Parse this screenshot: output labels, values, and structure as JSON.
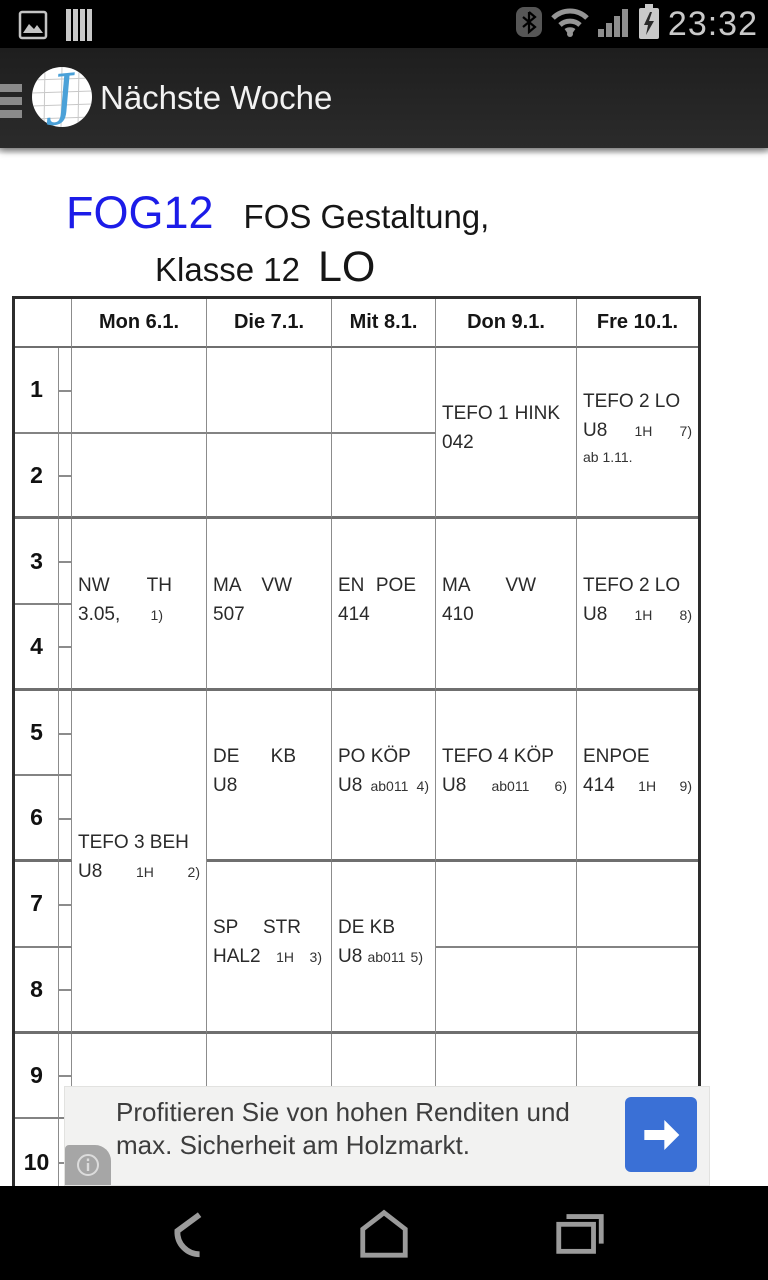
{
  "colors": {
    "class_code_blue": "#1c1ce8",
    "ad_button_blue": "#3a70d6",
    "logo_blue": "#4ba1d8",
    "appbar_bg": "#282828",
    "table_outer_border": "#2d2d2d"
  },
  "status_bar": {
    "time": "23:32",
    "left_icons": [
      "screenshot-icon",
      "sim-stack-icon"
    ],
    "right_icons": [
      "bluetooth-icon",
      "wifi-icon",
      "signal-icon",
      "battery-charging-icon"
    ]
  },
  "app_bar": {
    "title": "Nächste Woche",
    "logo_letter": "J"
  },
  "page_title": {
    "class_code": "FOG12",
    "subtitle": "FOS Gestaltung,",
    "line2": "Klasse 12",
    "teacher": "LO"
  },
  "timetable": {
    "corner": "",
    "periods": [
      "1",
      "2",
      "3",
      "4",
      "5",
      "6",
      "7",
      "8",
      "9",
      "10"
    ],
    "days": [
      {
        "id": "mon",
        "label": "Mon 6.1.",
        "cells": [
          {
            "r": 1,
            "span": 1,
            "lines": []
          },
          {
            "r": 2,
            "span": 1,
            "lines": []
          },
          {
            "r": 3,
            "span": 2,
            "lines": [
              {
                "pr": 28,
                "seg": [
                  {
                    "t": "NW"
                  },
                  {
                    "t": "TH"
                  }
                ]
              },
              {
                "pr": 37,
                "seg": [
                  {
                    "t": "3.05,"
                  },
                  {
                    "t": "1)",
                    "s": 1
                  }
                ]
              }
            ]
          },
          {
            "r": 5,
            "span": 4,
            "lines": [
              {
                "seg": [
                  {
                    "t": "TEFO 3 BEH"
                  }
                ]
              },
              {
                "pr": 0,
                "seg": [
                  {
                    "t": "U8"
                  },
                  {
                    "t": "1H",
                    "s": 1
                  },
                  {
                    "t": "2)",
                    "s": 1
                  }
                ]
              }
            ]
          },
          {
            "r": 9,
            "span": 1,
            "lines": []
          },
          {
            "r": 10,
            "span": 1,
            "lines": []
          }
        ]
      },
      {
        "id": "die",
        "label": "Die 7.1.",
        "cells": [
          {
            "r": 1,
            "span": 1,
            "lines": []
          },
          {
            "r": 2,
            "span": 1,
            "lines": []
          },
          {
            "r": 3,
            "span": 2,
            "lines": [
              {
                "pr": 33,
                "seg": [
                  {
                    "t": "MA"
                  },
                  {
                    "t": "VW"
                  }
                ]
              },
              {
                "seg": [
                  {
                    "t": "507"
                  }
                ]
              }
            ]
          },
          {
            "r": 5,
            "span": 2,
            "lines": [
              {
                "pr": 29,
                "seg": [
                  {
                    "t": "DE"
                  },
                  {
                    "t": "KB"
                  }
                ]
              },
              {
                "seg": [
                  {
                    "t": "U8"
                  }
                ]
              }
            ]
          },
          {
            "r": 7,
            "span": 2,
            "lines": [
              {
                "pr": 24,
                "seg": [
                  {
                    "t": "SP"
                  },
                  {
                    "t": "STR"
                  }
                ]
              },
              {
                "pr": 3,
                "seg": [
                  {
                    "t": "HAL2"
                  },
                  {
                    "t": "1H",
                    "s": 1
                  },
                  {
                    "t": "3)",
                    "s": 1
                  }
                ]
              }
            ]
          },
          {
            "r": 9,
            "span": 1,
            "lines": []
          },
          {
            "r": 10,
            "span": 1,
            "lines": []
          }
        ]
      },
      {
        "id": "mit",
        "label": "Mit 8.1.",
        "cells": [
          {
            "r": 1,
            "span": 1,
            "lines": []
          },
          {
            "r": 2,
            "span": 1,
            "lines": []
          },
          {
            "r": 3,
            "span": 2,
            "lines": [
              {
                "pr": 13,
                "seg": [
                  {
                    "t": "EN"
                  },
                  {
                    "t": "POE"
                  }
                ]
              },
              {
                "seg": [
                  {
                    "t": "414"
                  }
                ]
              }
            ]
          },
          {
            "r": 5,
            "span": 2,
            "lines": [
              {
                "seg": [
                  {
                    "t": "PO KÖP"
                  }
                ]
              },
              {
                "pr": 0,
                "seg": [
                  {
                    "t": "U8"
                  },
                  {
                    "t": "ab011",
                    "s": 1
                  },
                  {
                    "t": "4)",
                    "s": 1
                  }
                ]
              }
            ]
          },
          {
            "r": 7,
            "span": 2,
            "lines": [
              {
                "seg": [
                  {
                    "t": "DE KB"
                  }
                ]
              },
              {
                "pr": 6,
                "seg": [
                  {
                    "t": "U8"
                  },
                  {
                    "t": "ab011",
                    "s": 1
                  },
                  {
                    "t": "5)",
                    "s": 1
                  }
                ]
              }
            ]
          },
          {
            "r": 9,
            "span": 1,
            "lines": []
          },
          {
            "r": 10,
            "span": 1,
            "lines": []
          }
        ]
      },
      {
        "id": "don",
        "label": "Don 9.1.",
        "cells": [
          {
            "r": 1,
            "span": 2,
            "lines": [
              {
                "pr": 10,
                "seg": [
                  {
                    "t": "TEFO 1"
                  },
                  {
                    "t": "HINK"
                  }
                ]
              },
              {
                "seg": [
                  {
                    "t": "042"
                  }
                ]
              }
            ]
          },
          {
            "r": 3,
            "span": 2,
            "lines": [
              {
                "pr": 34,
                "seg": [
                  {
                    "t": "MA"
                  },
                  {
                    "t": "VW"
                  }
                ]
              },
              {
                "seg": [
                  {
                    "t": "410"
                  }
                ]
              }
            ]
          },
          {
            "r": 5,
            "span": 2,
            "lines": [
              {
                "seg": [
                  {
                    "t": "TEFO 4 KÖP"
                  }
                ]
              },
              {
                "pr": 3,
                "seg": [
                  {
                    "t": "U8"
                  },
                  {
                    "t": "ab011",
                    "s": 1
                  },
                  {
                    "t": "6)",
                    "s": 1
                  }
                ]
              }
            ]
          },
          {
            "r": 7,
            "span": 1,
            "lines": []
          },
          {
            "r": 8,
            "span": 1,
            "lines": []
          },
          {
            "r": 9,
            "span": 1,
            "lines": []
          },
          {
            "r": 10,
            "span": 1,
            "lines": []
          }
        ]
      },
      {
        "id": "fre",
        "label": "Fre 10.1.",
        "cells": [
          {
            "r": 1,
            "span": 2,
            "lines": [
              {
                "seg": [
                  {
                    "t": "TEFO 2 LO"
                  }
                ]
              },
              {
                "pr": 0,
                "seg": [
                  {
                    "t": "U8"
                  },
                  {
                    "t": "1H",
                    "s": 1
                  },
                  {
                    "t": "7)",
                    "s": 1
                  }
                ]
              },
              {
                "seg": [
                  {
                    "t": "ab 1.11.",
                    "s": 1
                  }
                ]
              }
            ]
          },
          {
            "r": 3,
            "span": 2,
            "lines": [
              {
                "seg": [
                  {
                    "t": "TEFO 2 LO"
                  }
                ]
              },
              {
                "pr": 0,
                "seg": [
                  {
                    "t": "U8"
                  },
                  {
                    "t": "1H",
                    "s": 1
                  },
                  {
                    "t": "8)",
                    "s": 1
                  }
                ]
              }
            ]
          },
          {
            "r": 5,
            "span": 2,
            "lines": [
              {
                "pr": 44,
                "seg": [
                  {
                    "t": "EN"
                  },
                  {
                    "t": "POE"
                  }
                ]
              },
              {
                "pr": 0,
                "seg": [
                  {
                    "t": "414"
                  },
                  {
                    "t": "1H",
                    "s": 1
                  },
                  {
                    "t": "9)",
                    "s": 1
                  }
                ]
              }
            ]
          },
          {
            "r": 7,
            "span": 1,
            "lines": []
          },
          {
            "r": 8,
            "span": 1,
            "lines": []
          },
          {
            "r": 9,
            "span": 1,
            "lines": []
          },
          {
            "r": 10,
            "span": 1,
            "lines": []
          }
        ]
      }
    ]
  },
  "ad": {
    "line1": "Profitieren Sie von hohen Renditen und",
    "line2": "max. Sicherheit am Holzmarkt.",
    "cta_icon": "arrow-right-icon",
    "info_icon": "ad-info-icon"
  },
  "nav_bar": {
    "icons": [
      "back-icon",
      "home-icon",
      "recents-icon"
    ]
  }
}
